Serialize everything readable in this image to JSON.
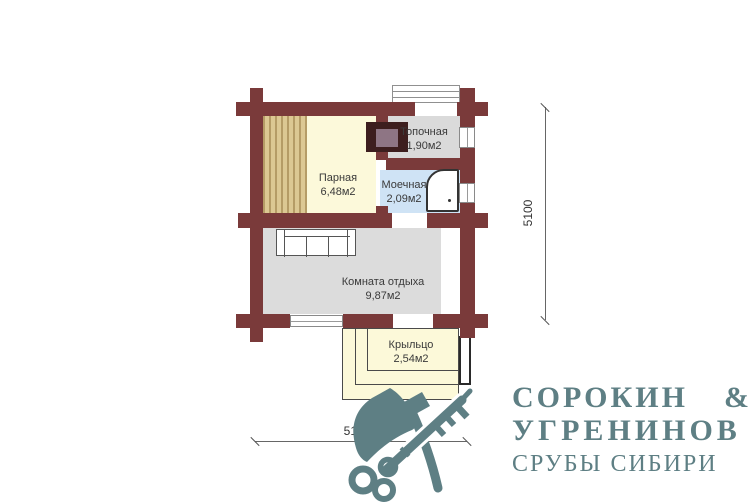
{
  "plan": {
    "rooms": [
      {
        "name": "Парная",
        "area": "6,48м2"
      },
      {
        "name": "Топочная",
        "area": "1,90м2"
      },
      {
        "name": "Моечная",
        "area": "2,09м2"
      },
      {
        "name": "Комната отдыха",
        "area": "9,87м2"
      },
      {
        "name": "Крыльцо",
        "area": "2,54м2"
      }
    ],
    "dimensions": {
      "vertical": "5100",
      "horizontal": "5100"
    },
    "colors": {
      "wall": "#7a3a3a",
      "steam_room_floor": "#fcf9da",
      "bench_planks": "#dcc893",
      "furnace_room_floor": "#dadada",
      "washing_room_floor": "#cfe3f5",
      "rest_room_floor": "#dcdcdc",
      "porch_floor": "#fcf9d9",
      "stove_outer": "#3d1e1e",
      "stove_inner": "#8e7584",
      "logo": "#5e7f84"
    }
  },
  "logo": {
    "line1_left": "СОРОКИН",
    "line1_amp": "&",
    "line2": "УГРЕНИНОВ",
    "line3": "СРУБЫ СИБИРИ"
  },
  "icons": {
    "axe": "axe-icon",
    "key": "key-icon"
  }
}
